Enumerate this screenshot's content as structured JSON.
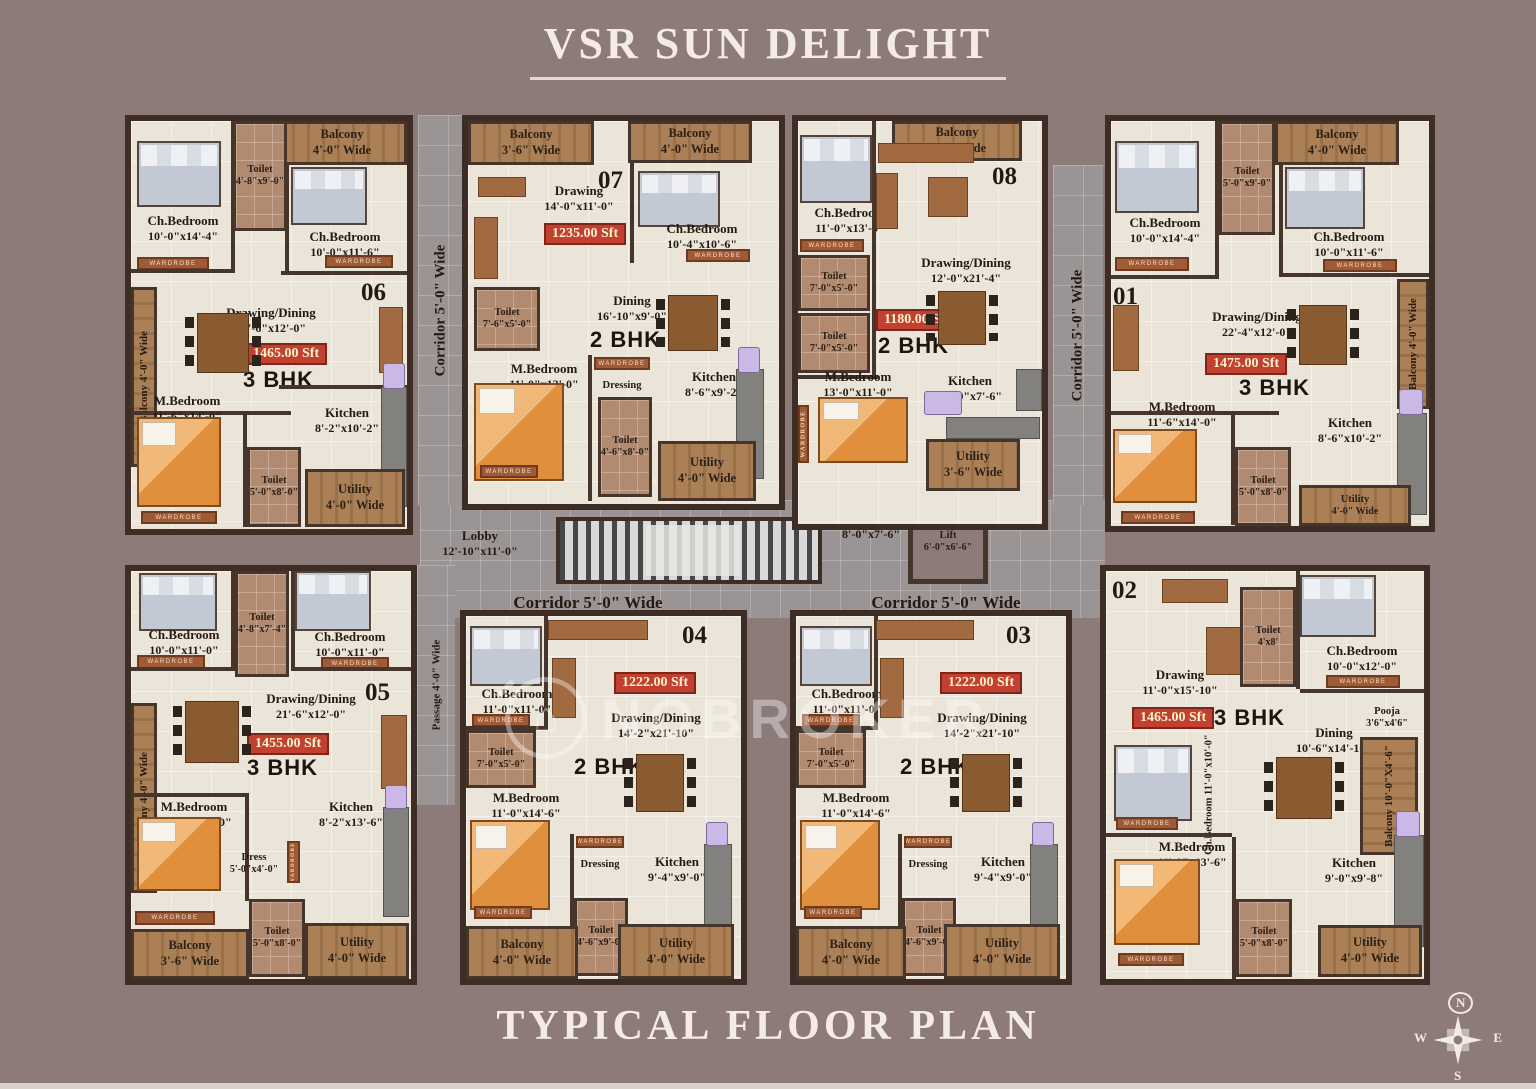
{
  "title": "VSR SUN DELIGHT",
  "footer": "TYPICAL FLOOR PLAN",
  "watermark": "NOBROKER",
  "labels": {
    "wardrobe": "WARDROBE"
  },
  "colors": {
    "background": "#8d7b7a",
    "floor": "#eae5d8",
    "wall": "#3d2d24",
    "area_badge": "#c2402f",
    "wood": "#ab8057",
    "corridor": "#9b9495"
  },
  "compass": {
    "north": "N",
    "south": "S",
    "east": "E",
    "west": "W"
  },
  "corridors": {
    "left_vertical": "Corridor 5'-0\" Wide",
    "right_vertical": "Corridor 5'-0\" Wide",
    "bottom_left": "Corridor 5'-0\" Wide",
    "bottom_right": "Corridor 5'-0\" Wide",
    "passage": "Passage 4'-0\" Wide"
  },
  "common": {
    "lobby1": {
      "name": "Lobby",
      "dim": "12'-10\"x11'-0\""
    },
    "lobby2": {
      "name": "Lobby",
      "dim": "8'-0\"x7'-6\""
    },
    "lift": {
      "name": "Lift",
      "dim": "6'-0\"x6'-6\""
    }
  },
  "units": {
    "u06": {
      "number": "06",
      "type": "3 BHK",
      "area": "1465.00 Sft",
      "rooms": {
        "balcony_top": {
          "name": "Balcony",
          "dim": "4'-0\" Wide"
        },
        "toilet_top": {
          "name": "Toilet",
          "dim": "4'-8\"x9'-0\""
        },
        "chbed1": {
          "name": "Ch.Bedroom",
          "dim": "10'-0\"x14'-4\""
        },
        "chbed2": {
          "name": "Ch.Bedroom",
          "dim": "10'-0\"x11'-6\""
        },
        "balcony_left": {
          "name": "Balcony",
          "dim": "4'-0\" Wide"
        },
        "drawing": {
          "name": "Drawing/Dining",
          "dim": "21'-6\"x12'-0\""
        },
        "mbed": {
          "name": "M.Bedroom",
          "dim": "11'-6\"x14'-0\""
        },
        "kitchen": {
          "name": "Kitchen",
          "dim": "8'-2\"x10'-2\""
        },
        "toilet2": {
          "name": "Toilet",
          "dim": "5'-0\"x8'-0\""
        },
        "utility": {
          "name": "Utility",
          "dim": "4'-0\" Wide"
        }
      }
    },
    "u07": {
      "number": "07",
      "type": "2 BHK",
      "area": "1235.00 Sft",
      "rooms": {
        "balcony1": {
          "name": "Balcony",
          "dim": "3'-6\" Wide"
        },
        "balcony2": {
          "name": "Balcony",
          "dim": "4'-0\" Wide"
        },
        "drawing": {
          "name": "Drawing",
          "dim": "14'-0\"x11'-0\""
        },
        "chbed": {
          "name": "Ch.Bedroom",
          "dim": "10'-4\"x10'-6\""
        },
        "toilet1": {
          "name": "Toilet",
          "dim": "7'-6\"x5'-0\""
        },
        "dining": {
          "name": "Dining",
          "dim": "16'-10\"x9'-0\""
        },
        "mbed": {
          "name": "M.Bedroom",
          "dim": "11'-0\"x13'-0\""
        },
        "dressing": {
          "name": "Dressing",
          "dim": ""
        },
        "kitchen": {
          "name": "Kitchen",
          "dim": "8'-6\"x9'-2\""
        },
        "toilet2": {
          "name": "Toilet",
          "dim": "4'-6\"x8'-0\""
        },
        "utility": {
          "name": "Utility",
          "dim": "4'-0\" Wide"
        }
      }
    },
    "u08": {
      "number": "08",
      "type": "2 BHK",
      "area": "1180.00 Sft",
      "rooms": {
        "balcony": {
          "name": "Balcony",
          "dim": "3'-6\" Wide"
        },
        "chbed": {
          "name": "Ch.Bedroom",
          "dim": "11'-0\"x13'-0\""
        },
        "toilet1": {
          "name": "Toilet",
          "dim": "7'-0\"x5'-0\""
        },
        "toilet2": {
          "name": "Toilet",
          "dim": "7'-0\"x5'-0\""
        },
        "drawing": {
          "name": "Drawing/Dining",
          "dim": "12'-0\"x21'-4\""
        },
        "mbed": {
          "name": "M.Bedroom",
          "dim": "13'-0\"x11'-0\""
        },
        "kitchen": {
          "name": "Kitchen",
          "dim": "10'-0\"x7'-6\""
        },
        "utility": {
          "name": "Utility",
          "dim": "3'-6\" Wide"
        }
      }
    },
    "u01": {
      "number": "01",
      "type": "3 BHK",
      "area": "1475.00 Sft",
      "rooms": {
        "balcony_top": {
          "name": "Balcony",
          "dim": "4'-0\" Wide"
        },
        "toilet_top": {
          "name": "Toilet",
          "dim": "5'-0\"x9'-0\""
        },
        "chbed1": {
          "name": "Ch.Bedroom",
          "dim": "10'-0\"x14'-4\""
        },
        "chbed2": {
          "name": "Ch.Bedroom",
          "dim": "10'-0\"x11'-6\""
        },
        "drawing": {
          "name": "Drawing/Dining",
          "dim": "22'-4\"x12'-0\""
        },
        "balcony_right": {
          "name": "Balcony",
          "dim": "4'-0\" Wide"
        },
        "mbed": {
          "name": "M.Bedroom",
          "dim": "11'-6\"x14'-0\""
        },
        "kitchen": {
          "name": "Kitchen",
          "dim": "8'-6\"x10'-2\""
        },
        "toilet2": {
          "name": "Toilet",
          "dim": "5'-0\"x8'-0\""
        },
        "utility": {
          "name": "Utility",
          "dim": "4'-0\" Wide"
        }
      }
    },
    "u05": {
      "number": "05",
      "type": "3 BHK",
      "area": "1455.00 Sft",
      "rooms": {
        "toilet_top": {
          "name": "Toilet",
          "dim": "4'-8\"x7'-4\""
        },
        "chbed1": {
          "name": "Ch.Bedroom",
          "dim": "10'-0\"x11'-0\""
        },
        "chbed2": {
          "name": "Ch.Bedroom",
          "dim": "10'-0\"x11'-0\""
        },
        "balcony_left": {
          "name": "Balcony",
          "dim": "4'-0\" Wide"
        },
        "drawing": {
          "name": "Drawing/Dining",
          "dim": "21'-6\"x12'-0\""
        },
        "mbed": {
          "name": "M.Bedroom",
          "dim": "11'-6\"x13'-10\""
        },
        "kitchen": {
          "name": "Kitchen",
          "dim": "8'-2\"x13'-6\""
        },
        "dress": {
          "name": "Dress",
          "dim": "5'-0\"x4'-0\""
        },
        "toilet2": {
          "name": "Toilet",
          "dim": "5'-0\"x8'-0\""
        },
        "balcony_bottom": {
          "name": "Balcony",
          "dim": "3'-6\" Wide"
        },
        "utility": {
          "name": "Utility",
          "dim": "4'-0\" Wide"
        }
      }
    },
    "u04": {
      "number": "04",
      "type": "2 BHK",
      "area": "1222.00 Sft",
      "rooms": {
        "chbed": {
          "name": "Ch.Bedroom",
          "dim": "11'-0\"x11'-0\""
        },
        "toilet1": {
          "name": "Toilet",
          "dim": "7'-0\"x5'-0\""
        },
        "drawing": {
          "name": "Drawing/Dining",
          "dim": "14'-2\"x21'-10\""
        },
        "mbed": {
          "name": "M.Bedroom",
          "dim": "11'-0\"x14'-6\""
        },
        "dressing": {
          "name": "Dressing",
          "dim": ""
        },
        "kitchen": {
          "name": "Kitchen",
          "dim": "9'-4\"x9'-0\""
        },
        "toilet2": {
          "name": "Toilet",
          "dim": "4'-6\"x9'-0\""
        },
        "balcony": {
          "name": "Balcony",
          "dim": "4'-0\" Wide"
        },
        "utility": {
          "name": "Utility",
          "dim": "4'-0\" Wide"
        }
      }
    },
    "u03": {
      "number": "03",
      "type": "2 BHK",
      "area": "1222.00 Sft",
      "rooms": {
        "chbed": {
          "name": "Ch.Bedroom",
          "dim": "11'-0\"x11'-0\""
        },
        "toilet1": {
          "name": "Toilet",
          "dim": "7'-0\"x5'-0\""
        },
        "drawing": {
          "name": "Drawing/Dining",
          "dim": "14'-2\"x21'-10\""
        },
        "mbed": {
          "name": "M.Bedroom",
          "dim": "11'-0\"x14'-6\""
        },
        "dressing": {
          "name": "Dressing",
          "dim": ""
        },
        "kitchen": {
          "name": "Kitchen",
          "dim": "9'-4\"x9'-0\""
        },
        "toilet2": {
          "name": "Toilet",
          "dim": "4'-6\"x9'-0\""
        },
        "balcony": {
          "name": "Balcony",
          "dim": "4'-0\" Wide"
        },
        "utility": {
          "name": "Utility",
          "dim": "4'-0\" Wide"
        }
      }
    },
    "u02": {
      "number": "02",
      "type": "3 BHK",
      "area": "1465.00 Sft",
      "rooms": {
        "drawing": {
          "name": "Drawing",
          "dim": "11'-0\"x15'-10\""
        },
        "toilet1": {
          "name": "Toilet",
          "dim": "4'x8'"
        },
        "chbed1": {
          "name": "Ch.Bedroom",
          "dim": "10'-0\"x12'-0\""
        },
        "pooja": {
          "name": "Pooja",
          "dim": "3'6\"x4'6\""
        },
        "dining": {
          "name": "Dining",
          "dim": "10'-6\"x14'-10\""
        },
        "chbed2": {
          "name": "Ch.Bedroom",
          "dim": "11'-0\"x10'-0\""
        },
        "balcony_right": {
          "name": "Balcony",
          "dim": "10'-0\"X4'-6\""
        },
        "mbed": {
          "name": "M.Bedroom",
          "dim": "11'-0\"x13'-6\""
        },
        "kitchen": {
          "name": "Kitchen",
          "dim": "9'-0\"x9'-8\""
        },
        "toilet2": {
          "name": "Toilet",
          "dim": "5'-0\"x8'-0\""
        },
        "utility": {
          "name": "Utility",
          "dim": "4'-0\" Wide"
        }
      }
    }
  }
}
